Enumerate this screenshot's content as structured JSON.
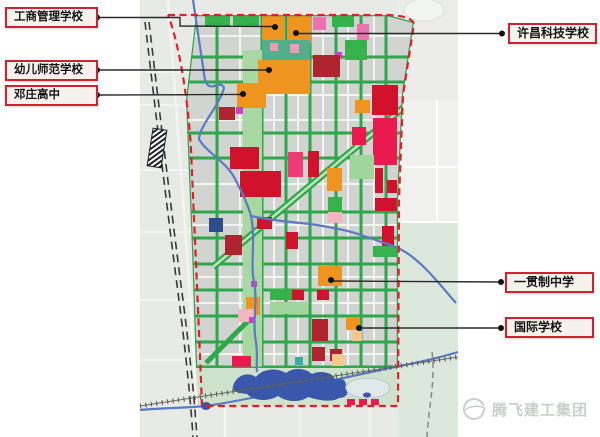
{
  "labels": [
    {
      "text": "工商管理学校"
    },
    {
      "text": "幼儿师范学校"
    },
    {
      "text": "邓庄高中"
    },
    {
      "text": "许昌科技学校"
    },
    {
      "text": "一贯制中学"
    },
    {
      "text": "国际学校"
    }
  ],
  "watermark": {
    "text": "腾飞建工集团"
  },
  "colors": {
    "base": "#e8ebe5",
    "grid": "#d2d4d2",
    "road_white": "#f3f5f1",
    "road_green": "#2ea64b",
    "boundary": "#e41e26",
    "leader": "#2b2b2b",
    "dot": "#111111",
    "orange": "#ef941f",
    "lightorange": "#f5c98c",
    "darkred": "#b02430",
    "crimson": "#d1122d",
    "brightred": "#ea1a51",
    "pinkred": "#ee3b77",
    "pink": "#ee72b0",
    "lightpink": "#f2b6be",
    "spotpink": "#f09cb8",
    "magenta": "#cb3fd0",
    "teal": "#53ae8c",
    "tealsmall": "#3fa9a5",
    "green": "#36b24c",
    "lightgreen": "#9fd69b",
    "parkstrip": "#a9d8a2",
    "darkblue": "#2e4c90",
    "lake": "#3a58ab",
    "river": "#5b79c4",
    "rail": "#3a3a3a",
    "pond": "#dfe9e9"
  },
  "map": {
    "bg": [
      {
        "x": 140,
        "y": 0,
        "w": 318,
        "h": 437,
        "f": "#e8ebe5"
      },
      {
        "x": 398,
        "y": 0,
        "w": 60,
        "h": 100,
        "f": "#ecedeb"
      },
      {
        "x": 398,
        "y": 100,
        "w": 60,
        "h": 122,
        "f": "#f0f0ee"
      },
      {
        "x": 398,
        "y": 222,
        "w": 60,
        "h": 215,
        "f": "#dce8dc"
      },
      {
        "x": 196,
        "y": 368,
        "w": 202,
        "h": 38,
        "f": "#cfe3cc"
      }
    ],
    "grid_poly": "196,15 388,15 414,22 403,95 398,200 398,368 196,368 192,250 186,100",
    "roads": {
      "white_h": [
        36,
        95,
        120,
        184,
        225,
        277,
        303,
        354
      ],
      "white_v": [
        240,
        274,
        298,
        323,
        348,
        374
      ],
      "green_h": [
        57,
        82,
        133,
        158,
        212,
        238,
        264,
        290,
        316,
        342,
        367
      ],
      "green_v": [
        217,
        262,
        286,
        310,
        336,
        361,
        386
      ]
    },
    "park_strip": {
      "x": 243,
      "y": 50,
      "w": 19,
      "h": 320
    },
    "diagonals": [
      {
        "x1": 410,
        "y1": 102,
        "x2": 213,
        "y2": 267,
        "w": 7,
        "c": "#2fa84c"
      },
      {
        "x1": 410,
        "y1": 102,
        "x2": 213,
        "y2": 267,
        "w": 2.5,
        "c": "#bfe3bb"
      },
      {
        "x1": 206,
        "y1": 363,
        "x2": 252,
        "y2": 317,
        "w": 5,
        "c": "#2fa84c"
      }
    ],
    "blocks": [
      [
        205,
        16,
        25,
        11,
        "green"
      ],
      [
        233,
        16,
        26,
        11,
        "green"
      ],
      [
        332,
        16,
        22,
        11,
        "green"
      ],
      [
        262,
        16,
        22,
        25,
        "orange"
      ],
      [
        287,
        16,
        24,
        27,
        "orange"
      ],
      [
        313,
        17,
        13,
        13,
        "pink"
      ],
      [
        357,
        24,
        12,
        16,
        "pink"
      ],
      [
        262,
        40,
        48,
        20,
        "teal"
      ],
      [
        270,
        43,
        8,
        8,
        "spotpink"
      ],
      [
        290,
        44,
        9,
        9,
        "spotpink"
      ],
      [
        345,
        40,
        22,
        20,
        "green"
      ],
      [
        335,
        52,
        7,
        7,
        "magenta"
      ],
      [
        313,
        55,
        27,
        22,
        "darkred"
      ],
      [
        258,
        60,
        52,
        34,
        "orange"
      ],
      [
        237,
        83,
        29,
        25,
        "orange"
      ],
      [
        236,
        107,
        7,
        7,
        "magenta"
      ],
      [
        219,
        107,
        16,
        13,
        "darkred"
      ],
      [
        372,
        85,
        26,
        30,
        "crimson"
      ],
      [
        355,
        100,
        15,
        13,
        "orange"
      ],
      [
        373,
        118,
        24,
        47,
        "brightred"
      ],
      [
        352,
        127,
        14,
        18,
        "brightred"
      ],
      [
        230,
        147,
        29,
        22,
        "crimson"
      ],
      [
        240,
        171,
        41,
        26,
        "crimson"
      ],
      [
        288,
        152,
        15,
        25,
        "pinkred"
      ],
      [
        308,
        151,
        11,
        26,
        "crimson"
      ],
      [
        350,
        155,
        24,
        24,
        "lightgreen"
      ],
      [
        327,
        168,
        15,
        23,
        "orange"
      ],
      [
        375,
        168,
        8,
        25,
        "crimson"
      ],
      [
        387,
        180,
        10,
        13,
        "crimson"
      ],
      [
        328,
        197,
        14,
        14,
        "green"
      ],
      [
        328,
        212,
        14,
        11,
        "lightpink"
      ],
      [
        375,
        198,
        22,
        13,
        "crimson"
      ],
      [
        209,
        218,
        14,
        14,
        "darkblue"
      ],
      [
        257,
        217,
        15,
        12,
        "crimson"
      ],
      [
        382,
        226,
        12,
        20,
        "crimson"
      ],
      [
        225,
        235,
        17,
        20,
        "darkred"
      ],
      [
        286,
        232,
        12,
        17,
        "crimson"
      ],
      [
        373,
        246,
        24,
        11,
        "green"
      ],
      [
        318,
        266,
        24,
        20,
        "orange"
      ],
      [
        251,
        281,
        6,
        6,
        "magenta"
      ],
      [
        270,
        289,
        22,
        11,
        "green"
      ],
      [
        292,
        290,
        12,
        10,
        "crimson"
      ],
      [
        317,
        290,
        12,
        10,
        "crimson"
      ],
      [
        246,
        297,
        14,
        18,
        "orange"
      ],
      [
        270,
        302,
        38,
        12,
        "lightgreen"
      ],
      [
        238,
        309,
        16,
        13,
        "lightpink"
      ],
      [
        249,
        317,
        6,
        6,
        "magenta"
      ],
      [
        312,
        319,
        16,
        22,
        "darkred"
      ],
      [
        346,
        317,
        14,
        13,
        "orange"
      ],
      [
        352,
        331,
        10,
        10,
        "lightorange"
      ],
      [
        312,
        347,
        13,
        14,
        "darkred"
      ],
      [
        330,
        349,
        12,
        12,
        "darkred"
      ],
      [
        332,
        354,
        12,
        12,
        "lightorange"
      ],
      [
        232,
        356,
        19,
        15,
        "brightred"
      ],
      [
        295,
        357,
        8,
        8,
        "tealsmall"
      ]
    ],
    "marks": [
      [
        347,
        399,
        8,
        6,
        "brightred"
      ],
      [
        359,
        399,
        8,
        6,
        "brightred"
      ],
      [
        371,
        399,
        8,
        6,
        "brightred"
      ]
    ],
    "boundary_path": "M 168,15 L 388,15 Q 412,16 414,24 L 403,95 L 399,200 L 398,406 L 202,406 C 199,330 195,240 191,150 C 188,95 178,40 168,15",
    "river_paths": [
      "M 193,0 L 205,80 C 210,95 220,78 224,88 C 218,108 200,125 199,139 C 205,151 226,162 234,177 C 242,192 248,205 251,216 C 256,240 250,262 254,282 C 258,302 252,322 256,342 C 258,356 256,365 257,372",
      "M 251,216 C 270,220 290,222 310,224 C 330,227 345,230 355,233 C 370,238 385,243 398,248 C 420,258 440,285 456,303",
      "M 140,410 C 160,408 185,408 206,406",
      "M 206,406 C 260,398 330,380 400,366 C 425,361 445,356 458,352"
    ],
    "lake_path": "M 233,386 C 236,376 247,371 256,377 C 262,369 276,367 286,373 C 293,367 306,368 312,374 C 320,370 332,372 335,379 C 343,377 348,382 345,388 C 350,392 347,398 339,398 C 331,403 318,400 308,397 C 300,403 286,402 278,396 C 268,402 254,401 247,394 C 239,393 231,392 233,386 Z",
    "ponds": [
      {
        "cx": 368,
        "cy": 388,
        "rx": 22,
        "ry": 10,
        "f": "#dfe9e9",
        "s": "#aebfd0"
      },
      {
        "cx": 334,
        "cy": 384,
        "rx": 5,
        "ry": 4,
        "f": "#3a58ab"
      },
      {
        "cx": 367,
        "cy": 395,
        "rx": 4,
        "ry": 2.5,
        "f": "#3a58ab"
      },
      {
        "cx": 206,
        "cy": 406,
        "rx": 5,
        "ry": 4,
        "f": "#3a58ab"
      }
    ],
    "rail_west": [
      "M 145,22 C 153,90 166,200 177,285 C 183,330 190,390 193,437",
      "M 149,22 C 157,90 170,200 181,285 C 187,330 194,390 197,437"
    ],
    "rail_station": {
      "x": 157,
      "y": 148,
      "w": 14,
      "h": 38,
      "rot": 9
    },
    "rail_bottom": {
      "x1": 140,
      "y1": 406,
      "x2": 458,
      "y2": 357
    },
    "gray_road": "M 432,352 C 436,380 428,410 427,437",
    "west_h_roads": [
      72,
      105,
      170,
      232,
      300,
      360
    ],
    "west_v_road": "M 168,0 C 172,60 180,150 186,240 C 190,300 196,380 198,437",
    "east_roads": {
      "h": [
        167,
        222
      ],
      "v": 437
    },
    "south_v_roads": [
      225,
      300,
      370
    ],
    "interchange": {
      "cx": 424,
      "cy": 10,
      "rx": 20,
      "ry": 11
    },
    "leaders": [
      {
        "pts": "97,17.5 180,17.5 180,26 275,26.5",
        "dots": [
          [
            97,
            17.5
          ],
          [
            275,
            27
          ]
        ]
      },
      {
        "pts": "97,70 269,70",
        "dots": [
          [
            97,
            70
          ],
          [
            269,
            70
          ]
        ]
      },
      {
        "pts": "97,95 243,94.5",
        "dots": [
          [
            97,
            95
          ],
          [
            243,
            94
          ]
        ]
      },
      {
        "pts": "502,33.5 296,33.5",
        "dots": [
          [
            502,
            33.5
          ],
          [
            296,
            33
          ]
        ]
      },
      {
        "pts": "501,282 331,281",
        "dots": [
          [
            501,
            282
          ],
          [
            331,
            280
          ]
        ]
      },
      {
        "pts": "501,328 359,328",
        "dots": [
          [
            501,
            328
          ],
          [
            359,
            328
          ]
        ]
      }
    ]
  }
}
